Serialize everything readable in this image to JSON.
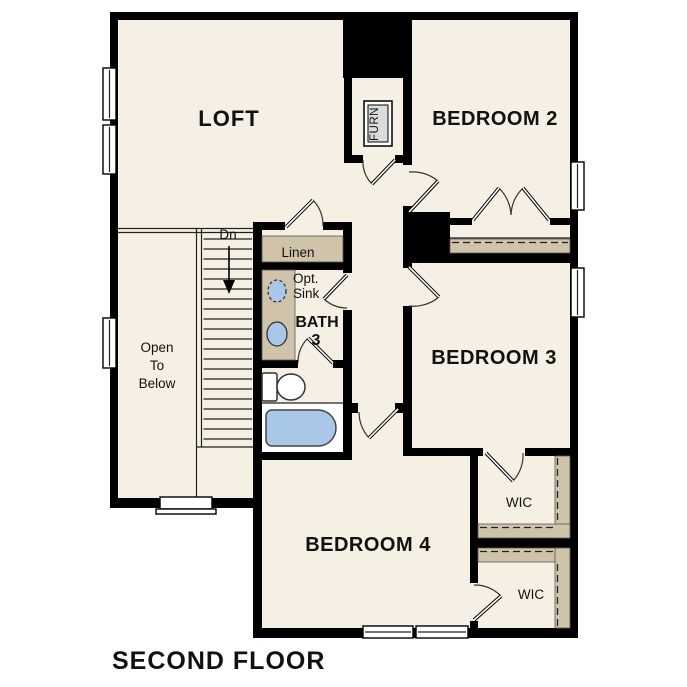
{
  "plan": {
    "title": "SECOND FLOOR",
    "rooms": {
      "loft": "LOFT",
      "bedroom2": "BEDROOM 2",
      "bedroom3": "BEDROOM 3",
      "bedroom4": "BEDROOM 4",
      "bath_line1": "BATH",
      "bath_line2": "3",
      "linen": "Linen",
      "wic_top": "WIC",
      "wic_bottom": "WIC",
      "furnace": "FURN",
      "opt_sink_line1": "Opt.",
      "opt_sink_line2": "Sink",
      "stairs_down": "Dn",
      "open_below_line1": "Open",
      "open_below_line2": "To",
      "open_below_line3": "Below"
    },
    "colors": {
      "floor": "#f6efe3",
      "walls": "#000000",
      "closet_shelf": "#cfc3aa",
      "fixture_blue": "#a9c7e8",
      "background": "#ffffff"
    }
  }
}
